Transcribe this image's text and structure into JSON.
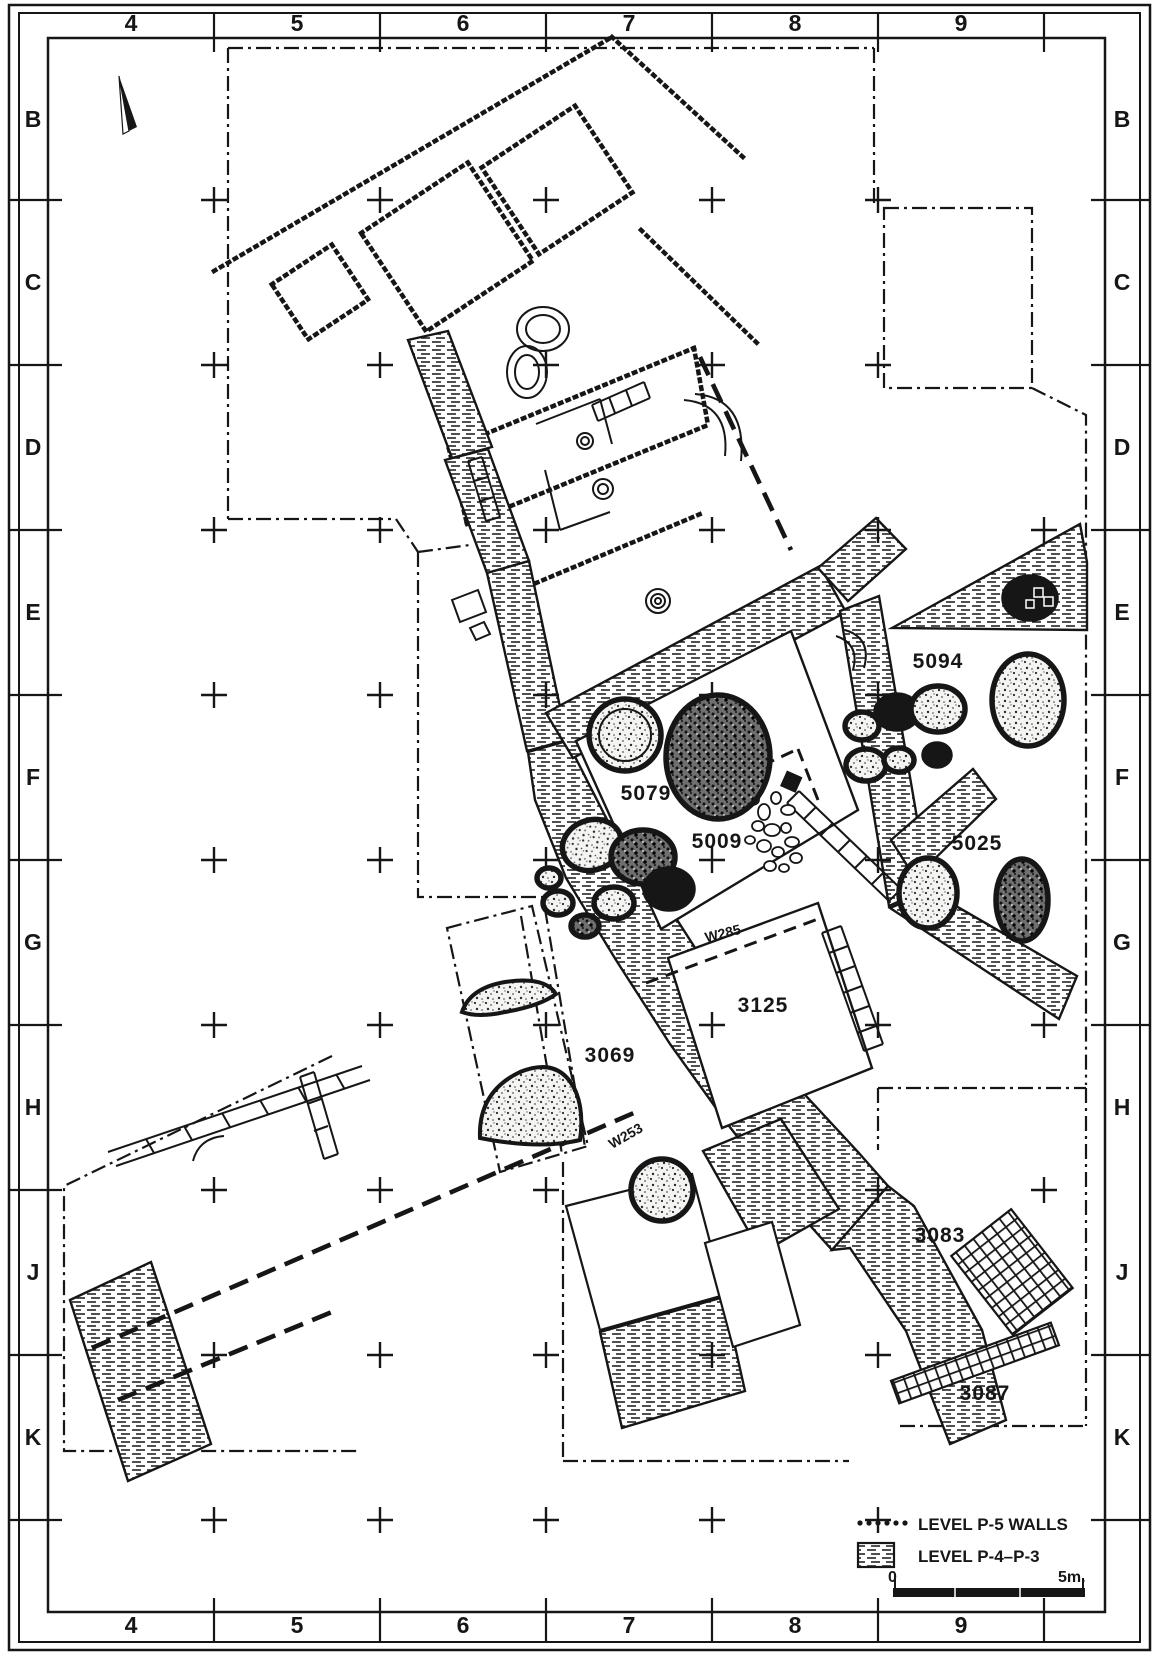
{
  "plan": {
    "grid": {
      "columns": [
        "4",
        "5",
        "6",
        "7",
        "8",
        "9"
      ],
      "rows": [
        "B",
        "C",
        "D",
        "E",
        "F",
        "G",
        "H",
        "J",
        "K"
      ]
    },
    "loci": [
      {
        "id": "5094"
      },
      {
        "id": "5079"
      },
      {
        "id": "5009"
      },
      {
        "id": "5025"
      },
      {
        "id": "3125"
      },
      {
        "id": "3069"
      },
      {
        "id": "3083"
      },
      {
        "id": "3087"
      }
    ],
    "walls": [
      {
        "id": "W285"
      },
      {
        "id": "W253"
      }
    ],
    "legend": {
      "p5": "LEVEL P-5 WALLS",
      "p43": "LEVEL P-4–P-3"
    },
    "scale": {
      "start": "0",
      "end": "5m."
    },
    "colors": {
      "ink": "#161616",
      "paper": "#ffffff"
    }
  }
}
